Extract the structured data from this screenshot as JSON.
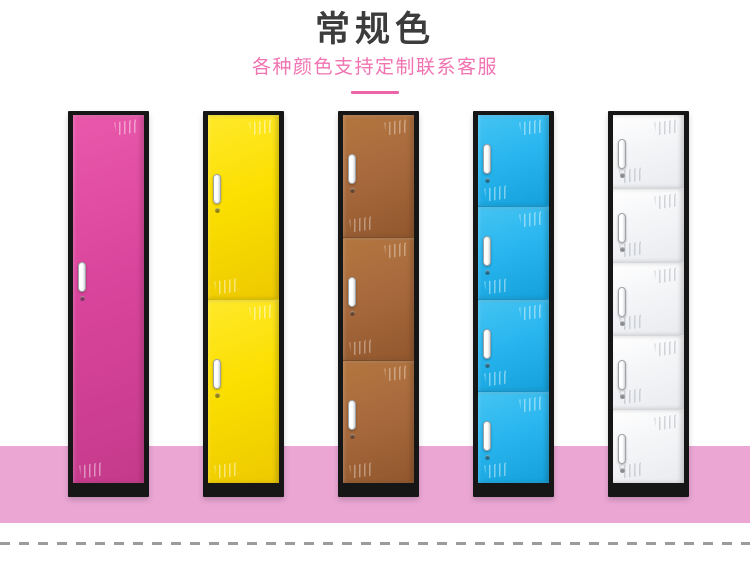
{
  "header": {
    "title": "常规色",
    "subtitle": "各种颜色支持定制联系客服",
    "title_color": "#3c3c3c",
    "subtitle_color": "#f173b1",
    "accent_color": "#ed64a9"
  },
  "scene": {
    "floor_color": "#eba6d4",
    "frame_color": "#161616",
    "locker_top": 111,
    "locker_width": 81,
    "locker_height": 386,
    "lockers": [
      {
        "id": "locker-pink-1-door",
        "label": "pink single-door locker",
        "doors": 1,
        "left": 68,
        "light": "#e958ab",
        "base": "#d9459c",
        "dark": "#c53a8b",
        "divider": "#b23080",
        "shine": "rgba(255,255,255,0.55)"
      },
      {
        "id": "locker-yellow-2-door",
        "label": "yellow two-door locker",
        "doors": 2,
        "left": 203,
        "light": "#ffe92a",
        "base": "#fbdf00",
        "dark": "#edc900",
        "divider": "#d4bd00",
        "shine": "rgba(255,255,255,0.6)"
      },
      {
        "id": "locker-brown-3-door",
        "label": "brown three-door locker",
        "doors": 3,
        "left": 338,
        "light": "#b4763f",
        "base": "#a86a3d",
        "dark": "#92572d",
        "divider": "#7d4a28",
        "shine": "rgba(255,255,255,0.45)"
      },
      {
        "id": "locker-blue-4-door",
        "label": "blue four-door locker",
        "doors": 4,
        "left": 473,
        "light": "#45c4f2",
        "base": "#29b6ef",
        "dark": "#14a0da",
        "divider": "#1592c7",
        "shine": "rgba(255,255,255,0.55)"
      },
      {
        "id": "locker-white-5-door",
        "label": "white five-door locker",
        "doors": 5,
        "left": 608,
        "light": "#ffffff",
        "base": "#f4f5f7",
        "dark": "#e9ebef",
        "divider": "#d5d7da",
        "shine": "rgba(150,156,166,0.5)"
      }
    ]
  },
  "footer": {
    "dash_color": "#9b9b9b"
  }
}
